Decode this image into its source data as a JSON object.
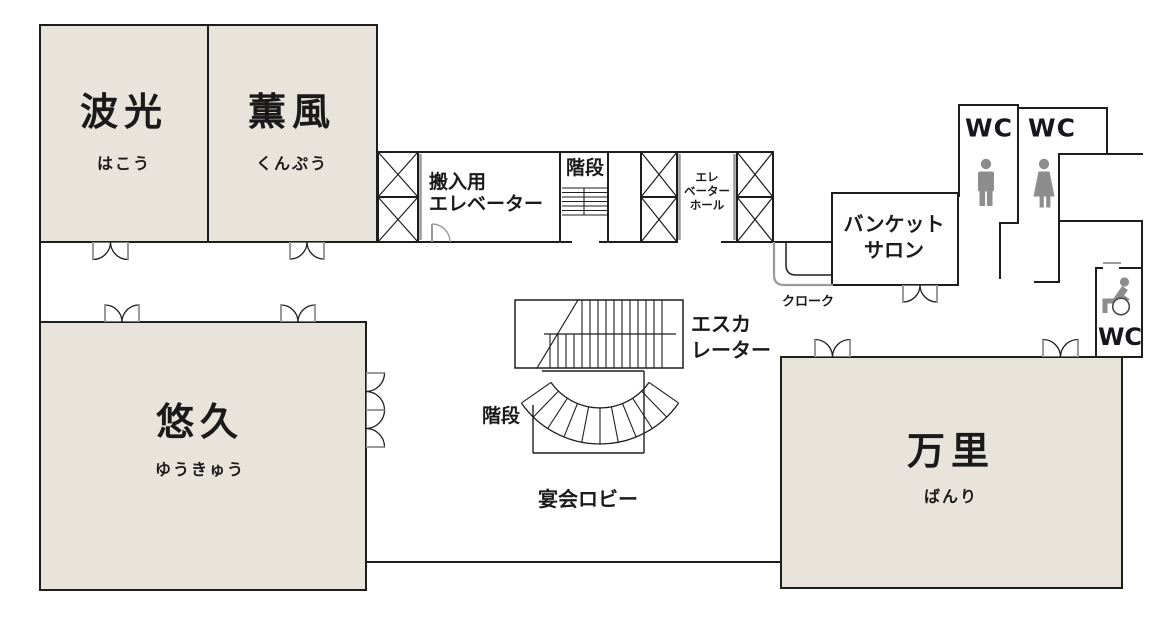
{
  "floor": {
    "rooms": [
      {
        "id": "hakou",
        "name": "波光",
        "reading": "はこう"
      },
      {
        "id": "kunpuu",
        "name": "薫風",
        "reading": "くんぷう"
      },
      {
        "id": "yuukyuu",
        "name": "悠久",
        "reading": "ゆうきゅう"
      },
      {
        "id": "banri",
        "name": "万里",
        "reading": "ばんり"
      }
    ],
    "labels": {
      "service_elevator": [
        "搬入用",
        "エレベーター"
      ],
      "stairs_upper": "階段",
      "elevator_hall": [
        "エレ",
        "ベーター",
        "ホール"
      ],
      "banquet_salon": [
        "バンケット",
        "サロン"
      ],
      "cloak": "クローク",
      "escalator": [
        "エスカ",
        "レーター"
      ],
      "stairs_curved": "階段",
      "banquet_lobby": "宴会ロビー",
      "wc_men": "WC",
      "wc_women": "WC",
      "wc_accessible": "WC"
    },
    "icons": [
      "man-icon",
      "woman-icon",
      "wheelchair-icon"
    ],
    "colors": {
      "room_fill": "#e9e4db",
      "wall": "#1e1e1c",
      "line_grey": "#9a9a9a",
      "icon_grey": "#8d8d8d",
      "text": "#1a1a1a",
      "wc_text": "#16161e"
    }
  }
}
